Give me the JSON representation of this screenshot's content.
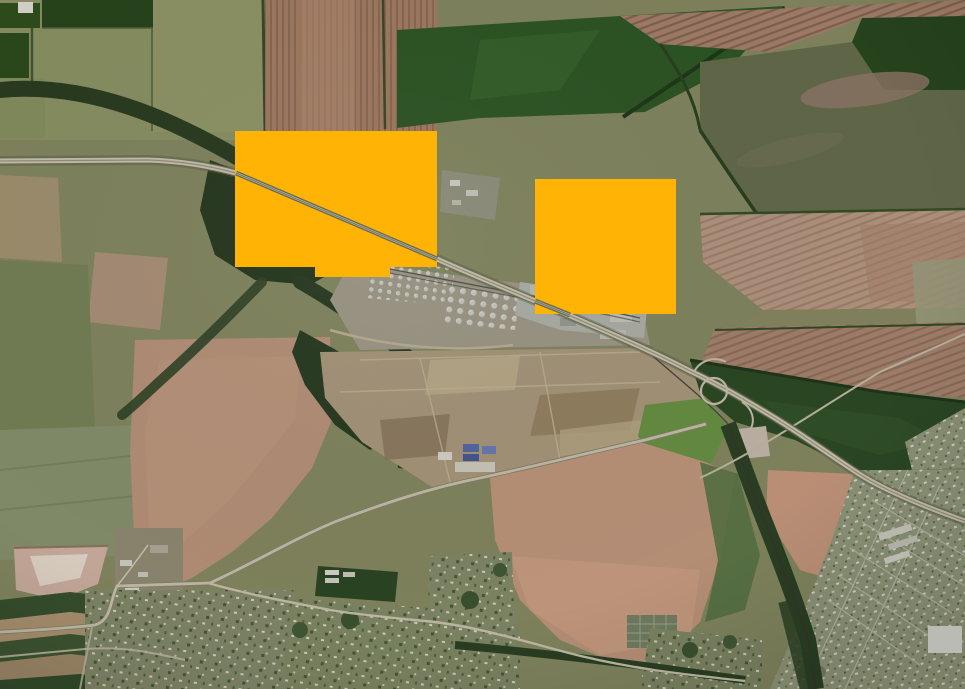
{
  "app": {
    "name": "satellite-map-view",
    "description": "Aerial satellite basemap of farmland, a refinery complex, highway and towns, with two solid orange annotation overlays"
  },
  "map": {
    "base_type": "satellite-imagery",
    "annotations": [
      {
        "id": "annotation-box-1",
        "color": "#FFB405",
        "x": 235,
        "y": 131,
        "width": 202,
        "height": 136,
        "notch": {
          "x": 315,
          "y": 267,
          "width": 75,
          "height": 10
        }
      },
      {
        "id": "annotation-box-2",
        "color": "#FFB405",
        "x": 535,
        "y": 179,
        "width": 141,
        "height": 135
      }
    ],
    "palette": {
      "overlay_orange": "#FFB405",
      "forest_dark": "#2C4023",
      "field_green_dark": "#2F5527",
      "field_olive": "#8C9066",
      "field_pink": "#B58A70",
      "field_salmon": "#CD9F83",
      "road_light": "#D6CFBA",
      "industrial_tan": "#B2A083",
      "town_gray": "#9AA182"
    }
  }
}
